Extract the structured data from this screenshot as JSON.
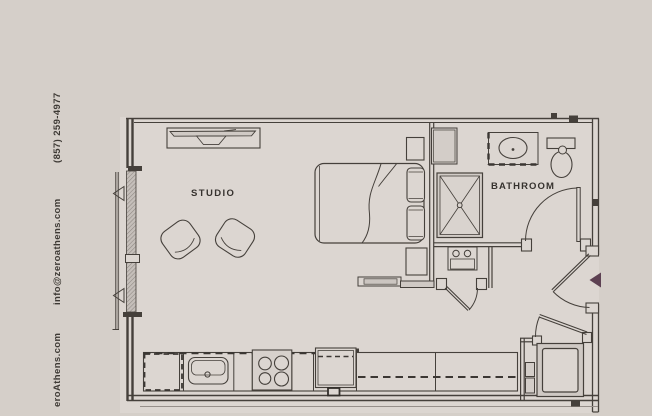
{
  "page": {
    "background_color": "#d5cfc9",
    "floor_color": "#dcd6d1",
    "line_color": "#45403b",
    "entry_marker_color": "#5d4152"
  },
  "contact": {
    "phone": "(857) 259-4977",
    "email": "info@zeroathens.com",
    "website": "eroAthens.com"
  },
  "rooms": {
    "studio": "STUDIO",
    "bathroom": "BATHROOM"
  },
  "fixtures": {
    "bed": "bed with two pillows",
    "chairs": "two armchairs",
    "media_console": "tv console",
    "kitchen": "sink, 4-burner stove, refrigerator, cabinets",
    "bathroom": "vanity sink, toilet, shower",
    "utility": "stacked unit closet, washer-dryer closet",
    "entry": "entry door with marker triangle"
  }
}
